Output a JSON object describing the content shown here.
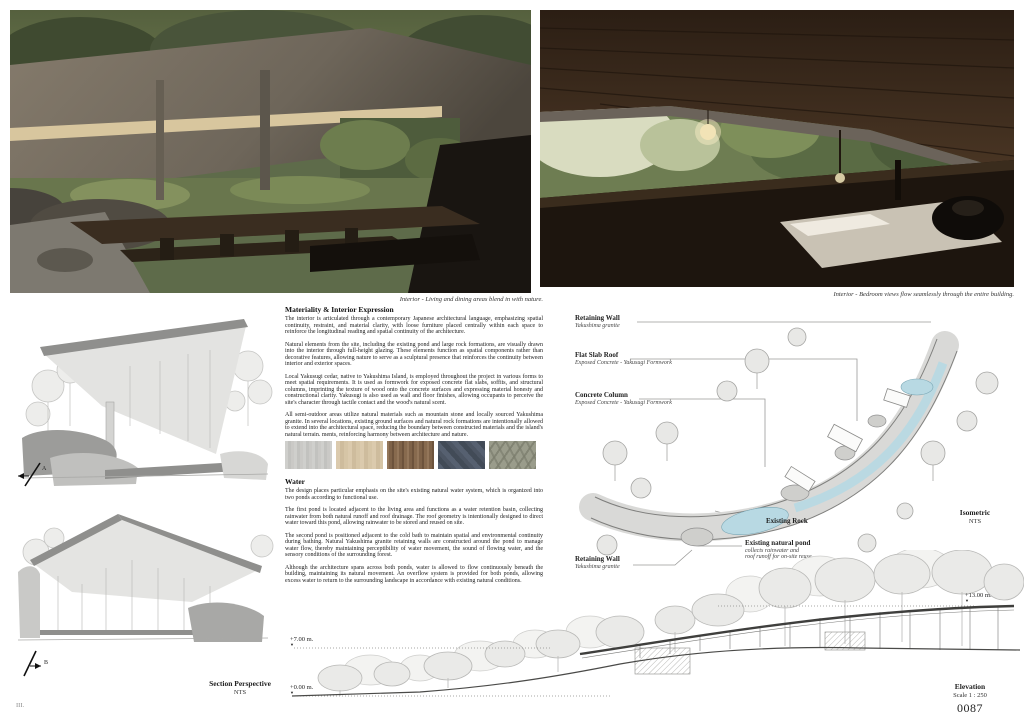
{
  "page": {
    "folio": "III.",
    "number": "0087"
  },
  "captions": {
    "living": "Interior - Living and dining areas blend in with nature.",
    "bedroom": "Interior - Bedroom views flow seamlessly through the entire building."
  },
  "materiality": {
    "heading": "Materiality & Interior Expression",
    "p1": "The interior is articulated through a contemporary Japanese architectural language, emphasizing spatial continuity, restraint, and material clarity, with loose furniture placed centrally within each space to reinforce the longitudinal reading and spatial continuity of the architecture.",
    "p2": "Natural elements from the site, including the existing pond and large rock formations, are visually drawn into the interior through full-height glazing. These elements function as spatial components rather than decorative features, allowing nature to serve as a sculptural presence that reinforces the continuity between interior and exterior spaces.",
    "p3": "Local Yakusugi cedar, native to Yakushima Island, is employed throughout the project in various forms to meet spatial requirements. It is used as formwork for exposed concrete flat slabs, soffits, and structural columns, imprinting the texture of wood onto the concrete surfaces and expressing material honesty and constructional clarity. Yakusugi is also used as wall and floor finishes, allowing occupants to perceive the site's character through tactile contact and the wood's natural scent.",
    "p4": "All semi-outdoor areas utilize natural materials such as mountain stone and locally sourced Yakushima granite. In several locations, existing ground surfaces and natural rock formations are intentionally allowed to extend into the architectural space, reducing the boundary between constructed materials and the island's natural terrain. ments, reinforcing harmony between architecture and nature.",
    "swatches": [
      "concrete-yakusugi-formwork",
      "light-cedar-wood",
      "yakusugi-plank-wall",
      "yakushima-granite",
      "natural-stone-paving"
    ]
  },
  "water": {
    "heading": "Water",
    "p1": "The design places particular emphasis on the site's existing natural water system, which is organized into two ponds according to functional use.",
    "p2": "The first pond is located adjacent to the living area and functions as a water retention basin, collecting rainwater from both natural runoff and roof drainage. The roof geometry is intentionally designed to direct water toward this pond, allowing rainwater to be stored and reused on site.",
    "p3": "The second pond is positioned adjacent to the cold bath to maintain spatial and environmental continuity during bathing. Natural Yakushima granite retaining walls are constructed around the pond to manage water flow, thereby maintaining perceptibility of water movement, the sound of flowing water, and the sensory conditions of the surrounding forest.",
    "p4": "Although the architecture spans across both ponds, water is allowed to flow continuously beneath the building, maintaining its natural movement. An overflow system is provided for both ponds, allowing excess water to return to the surrounding landscape in accordance with existing natural conditions."
  },
  "section_perspective": {
    "title": "Section Perspective",
    "scale": "NTS",
    "marker_a": "A",
    "marker_b": "B"
  },
  "isometric": {
    "title": "Isometric",
    "scale": "NTS",
    "labels": {
      "retaining_wall_top": {
        "title": "Retaining Wall",
        "sub": "Yakushima granite"
      },
      "flat_slab_roof": {
        "title": "Flat Slab Roof",
        "sub": "Exposed Concrete - Yakusugi Formwork"
      },
      "concrete_column": {
        "title": "Concrete Column",
        "sub": "Exposed Concrete - Yakusugi Formwork"
      },
      "existing_rock": {
        "title": "Existing Rock"
      },
      "existing_pond": {
        "title": "Existing natural pond",
        "sub1": "collects rainwater and",
        "sub2": "roof runoff for on-site reuse."
      },
      "retaining_wall_bottom": {
        "title": "Retaining Wall",
        "sub": "Yakushima granite"
      }
    }
  },
  "elevation": {
    "title": "Elevation",
    "scale": "Scale 1 : 250",
    "levels": {
      "top": "+13.00 m.",
      "mid": "+7.00 m.",
      "base": "+0.00 m."
    }
  },
  "colors": {
    "water_blue": "#b8d9e3",
    "drawing_gray": "#8f8f8f",
    "tree_gray": "#b8b8b6"
  }
}
